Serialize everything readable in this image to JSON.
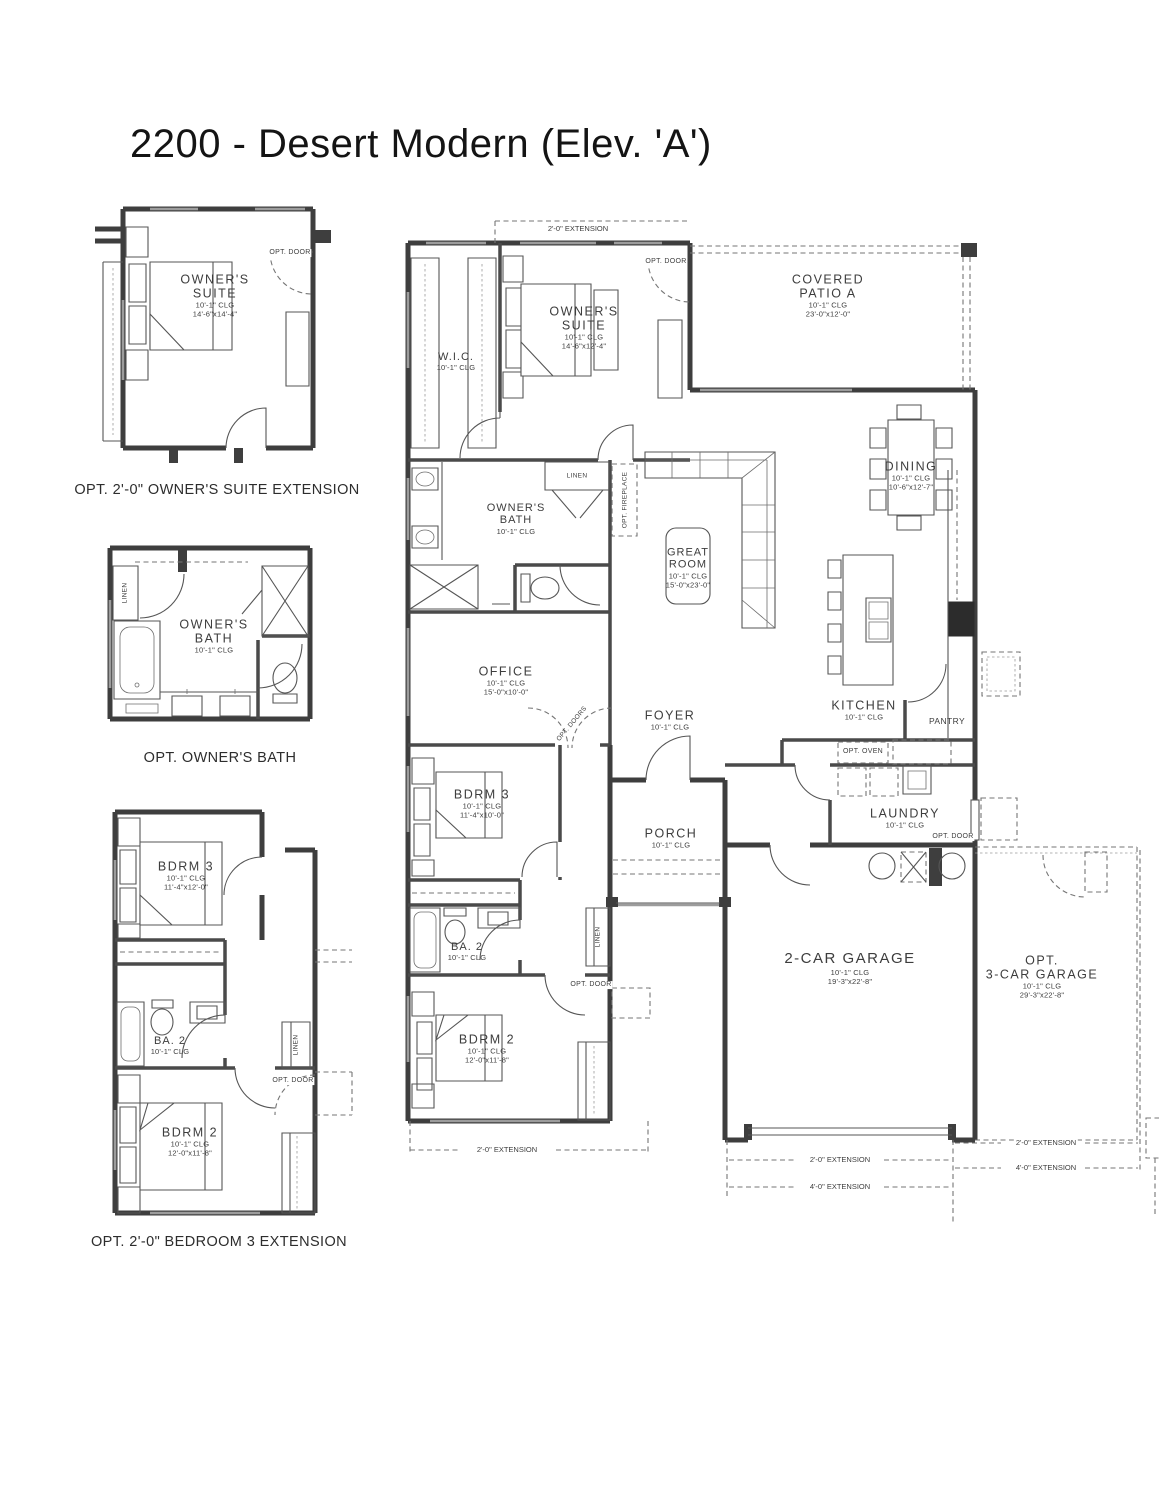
{
  "title": "2200 - Desert Modern (Elev. 'A')",
  "opt_suite": {
    "caption": "OPT. 2'-0\" OWNER'S SUITE EXTENSION",
    "name1": "OWNER'S",
    "name2": "SUITE",
    "clg": "10'-1\" CLG",
    "dims": "14'-6\"x14'-4\"",
    "opt_door": "OPT. DOOR"
  },
  "opt_bath": {
    "caption": "OPT. OWNER'S BATH",
    "name1": "OWNER'S",
    "name2": "BATH",
    "clg": "10'-1\" CLG",
    "linen": "LINEN"
  },
  "opt_bdrm": {
    "caption": "OPT. 2'-0\" BEDROOM 3 EXTENSION",
    "bdrm3": {
      "name": "BDRM 3",
      "clg": "10'-1\" CLG",
      "dims": "11'-4\"x12'-0\""
    },
    "ba2": {
      "name": "BA. 2",
      "clg": "10'-1\" CLG"
    },
    "bdrm2": {
      "name": "BDRM 2",
      "clg": "10'-1\" CLG",
      "dims": "12'-0\"x11'-8\""
    },
    "linen": "LINEN",
    "opt_door": "OPT. DOOR"
  },
  "main": {
    "ext_top": "2'-0\" EXTENSION",
    "wic": {
      "name": "W.I.C.",
      "clg": "10'-1\" CLG"
    },
    "suite": {
      "name1": "OWNER'S",
      "name2": "SUITE",
      "clg": "10'-1\" CLG",
      "dims": "14'-6\"x12'-4\""
    },
    "suite_opt_door": "OPT. DOOR",
    "patio": {
      "name1": "COVERED",
      "name2": "PATIO A",
      "clg": "10'-1\" CLG",
      "dims": "23'-0\"x12'-0\""
    },
    "dining": {
      "name": "DINING",
      "clg": "10'-1\" CLG",
      "dims": "10'-6\"x12'-7\""
    },
    "bath": {
      "name1": "OWNER'S",
      "name2": "BATH",
      "clg": "10'-1\" CLG"
    },
    "linen_hall": "LINEN",
    "opt_fireplace": "OPT. FIREPLACE",
    "great": {
      "name1": "GREAT",
      "name2": "ROOM",
      "clg": "10'-1\" CLG",
      "dims": "15'-0\"x23'-0\""
    },
    "office": {
      "name": "OFFICE",
      "clg": "10'-1\" CLG",
      "dims": "15'-0\"x10'-0\""
    },
    "opt_doors": "OPT. DOORS",
    "kitchen": {
      "name": "KITCHEN",
      "clg": "10'-1\" CLG"
    },
    "pantry": "PANTRY",
    "opt_oven": "OPT. OVEN",
    "foyer": {
      "name": "FOYER",
      "clg": "10'-1\" CLG"
    },
    "porch": {
      "name": "PORCH",
      "clg": "10'-1\" CLG"
    },
    "bdrm3": {
      "name": "BDRM 3",
      "clg": "10'-1\" CLG",
      "dims": "11'-4\"x10'-0\""
    },
    "ba2": {
      "name": "BA. 2",
      "clg": "10'-1\" CLG"
    },
    "linen_bed": "LINEN",
    "bdrm_opt_door": "OPT. DOOR",
    "bdrm2": {
      "name": "BDRM 2",
      "clg": "10'-1\" CLG",
      "dims": "12'-0\"x11'-8\""
    },
    "laundry": {
      "name": "LAUNDRY",
      "clg": "10'-1\" CLG"
    },
    "laundry_opt_door": "OPT. DOOR",
    "garage": {
      "name": "2-CAR GARAGE",
      "clg": "10'-1\" CLG",
      "dims": "19'-3\"x22'-8\""
    },
    "opt_garage": {
      "name1": "OPT.",
      "name2": "3-CAR GARAGE",
      "clg": "10'-1\" CLG",
      "dims": "29'-3\"x22'-8\""
    },
    "ext_bdrm2": "2'-0\" EXTENSION",
    "ext_gl2": "2'-0\" EXTENSION",
    "ext_gl4": "4'-0\" EXTENSION",
    "ext_gr2": "2'-0\" EXTENSION",
    "ext_gr4": "4'-0\" EXTENSION"
  }
}
